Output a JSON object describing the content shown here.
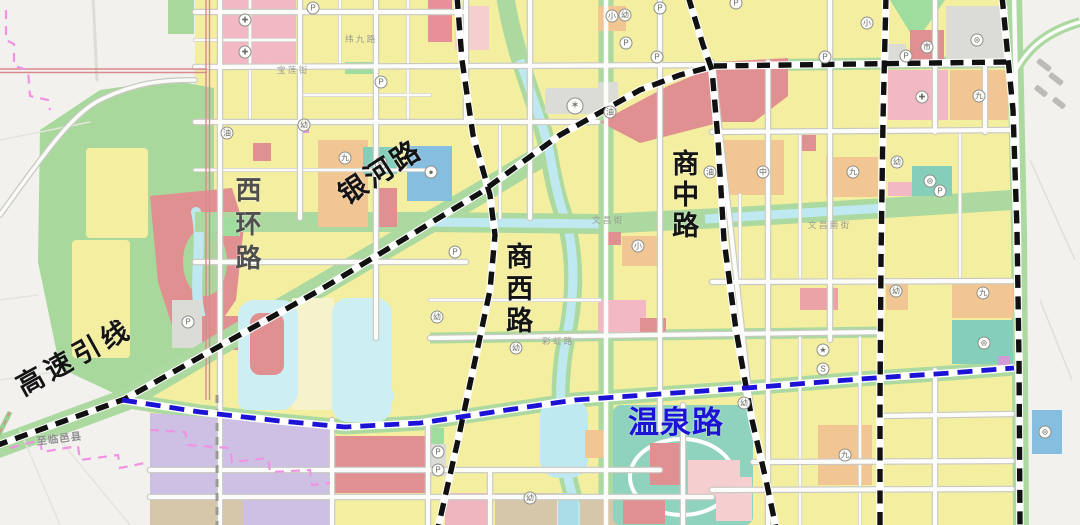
{
  "map": {
    "title": "城市规划图 (urban plan map section)",
    "palette": {
      "outside": "#f2f1ee",
      "block_yellow": "#f3eea0",
      "block_pale_yellow": "#f6f2cc",
      "park_green": "#a8d89b",
      "road_edge_green": "#abd99f",
      "water": "#cdeef3",
      "river": "#bfe9f0",
      "red_block": "#e09090",
      "pink_block": "#f2b9c4",
      "pale_pink_block": "#f5cfd0",
      "orange_block": "#f2c692",
      "teal_block": "#85cfba",
      "blue_block": "#85bede",
      "purple_block": "#cec0e4",
      "tan_block": "#d6c7a9",
      "gray_block": "#dcdcd6",
      "rail_red": "#d98b8b",
      "dash_black": "#111111",
      "dash_blue": "#1c13d6",
      "boundary_pink": "#f093e2",
      "label_gray": "#4f4f4f"
    },
    "road_labels": [
      {
        "id": "xihuan-road-label",
        "text": "西环路",
        "x": 233,
        "y": 176,
        "size": 26,
        "color": "#4f4f4f",
        "vertical": true,
        "ls": 8
      },
      {
        "id": "yinhe-road-label",
        "text": "银河路",
        "x": 334,
        "y": 186,
        "size": 28,
        "color": "#141414",
        "rot": -33,
        "ls": 3
      },
      {
        "id": "shangxi-road-label",
        "text": "商西路",
        "x": 503,
        "y": 242,
        "size": 27,
        "color": "#141414",
        "vertical": true,
        "ls": 5
      },
      {
        "id": "shangzhong-road-label",
        "text": "商中路",
        "x": 669,
        "y": 149,
        "size": 27,
        "color": "#141414",
        "vertical": true,
        "ls": 4
      },
      {
        "id": "expressway-link-label",
        "text": "高速引线",
        "x": 12,
        "y": 376,
        "size": 27,
        "color": "#141414",
        "rot": -29,
        "ls": 5
      },
      {
        "id": "wenquan-road-label",
        "text": "温泉路",
        "x": 628,
        "y": 407,
        "size": 31,
        "color": "#1c13d6",
        "ls": 1
      },
      {
        "id": "to-linyi-label",
        "text": "至临邑县",
        "x": 36,
        "y": 438,
        "size": 10.5,
        "color": "#8f8f8f",
        "rot": -7,
        "ls": 1
      }
    ],
    "street_labels": [
      {
        "text": "纬 九 路",
        "x": 345,
        "y": 33
      },
      {
        "text": "宝 莲 街",
        "x": 277,
        "y": 64
      },
      {
        "text": "文 昌 街",
        "x": 592,
        "y": 214
      },
      {
        "text": "文 昌 南 街",
        "x": 808,
        "y": 219
      },
      {
        "text": "彩 虹 路",
        "x": 542,
        "y": 335
      }
    ],
    "icons": [
      {
        "g": "P",
        "x": 313,
        "y": 8
      },
      {
        "g": "P",
        "x": 660,
        "y": 8
      },
      {
        "g": "P",
        "x": 736,
        "y": 3
      },
      {
        "g": "P",
        "x": 626,
        "y": 43
      },
      {
        "g": "P",
        "x": 381,
        "y": 82
      },
      {
        "g": "P",
        "x": 657,
        "y": 57
      },
      {
        "g": "P",
        "x": 825,
        "y": 57
      },
      {
        "g": "P",
        "x": 906,
        "y": 56
      },
      {
        "g": "P",
        "x": 940,
        "y": 191
      },
      {
        "g": "P",
        "x": 455,
        "y": 252
      },
      {
        "g": "P",
        "x": 188,
        "y": 322
      },
      {
        "g": "P",
        "x": 438,
        "y": 452
      },
      {
        "g": "P",
        "x": 438,
        "y": 470
      },
      {
        "g": "幼",
        "x": 304,
        "y": 125
      },
      {
        "g": "幼",
        "x": 625,
        "y": 15
      },
      {
        "g": "幼",
        "x": 897,
        "y": 162
      },
      {
        "g": "幼",
        "x": 437,
        "y": 317
      },
      {
        "g": "幼",
        "x": 516,
        "y": 348
      },
      {
        "g": "幼",
        "x": 530,
        "y": 498
      },
      {
        "g": "幼",
        "x": 896,
        "y": 291
      },
      {
        "g": "幼",
        "x": 744,
        "y": 403
      },
      {
        "g": "小",
        "x": 612,
        "y": 16
      },
      {
        "g": "小",
        "x": 867,
        "y": 23
      },
      {
        "g": "小",
        "x": 638,
        "y": 246
      },
      {
        "g": "中",
        "x": 763,
        "y": 172
      },
      {
        "g": "九",
        "x": 345,
        "y": 158
      },
      {
        "g": "九",
        "x": 853,
        "y": 172
      },
      {
        "g": "九",
        "x": 845,
        "y": 455
      },
      {
        "g": "九",
        "x": 983,
        "y": 293
      },
      {
        "g": "九",
        "x": 979,
        "y": 96
      },
      {
        "g": "⊜",
        "x": 381,
        "y": 163
      },
      {
        "g": "⊜",
        "x": 930,
        "y": 181
      },
      {
        "g": "⊜",
        "x": 984,
        "y": 343
      },
      {
        "g": "⊜",
        "x": 977,
        "y": 40
      },
      {
        "g": "⊜",
        "x": 1045,
        "y": 432
      },
      {
        "g": "✚",
        "x": 245,
        "y": 20
      },
      {
        "g": "✚",
        "x": 245,
        "y": 52
      },
      {
        "g": "✚",
        "x": 922,
        "y": 97
      },
      {
        "g": "市",
        "x": 927,
        "y": 47
      },
      {
        "g": "✶",
        "x": 575,
        "y": 106,
        "big": true
      },
      {
        "g": "★",
        "x": 823,
        "y": 350
      },
      {
        "g": "S",
        "x": 823,
        "y": 369
      },
      {
        "g": "●",
        "x": 431,
        "y": 172
      },
      {
        "g": "油",
        "x": 227,
        "y": 133
      },
      {
        "g": "油",
        "x": 710,
        "y": 172
      },
      {
        "g": "油",
        "x": 610,
        "y": 112
      }
    ]
  }
}
